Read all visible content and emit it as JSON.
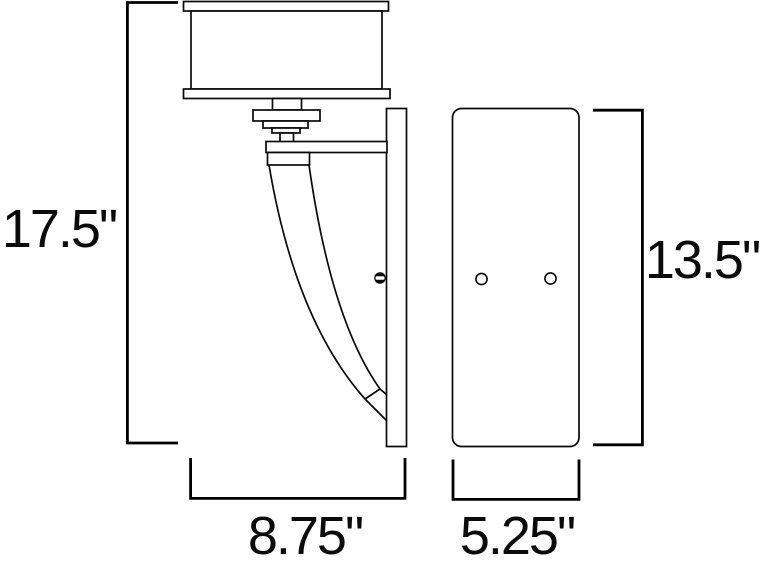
{
  "palette": {
    "ink": "#000000",
    "background": "#ffffff"
  },
  "dimension_labels": {
    "overall_height": "17.5\"",
    "overall_depth": "8.75\"",
    "backplate_height": "13.5\"",
    "backplate_width": "5.25\""
  }
}
